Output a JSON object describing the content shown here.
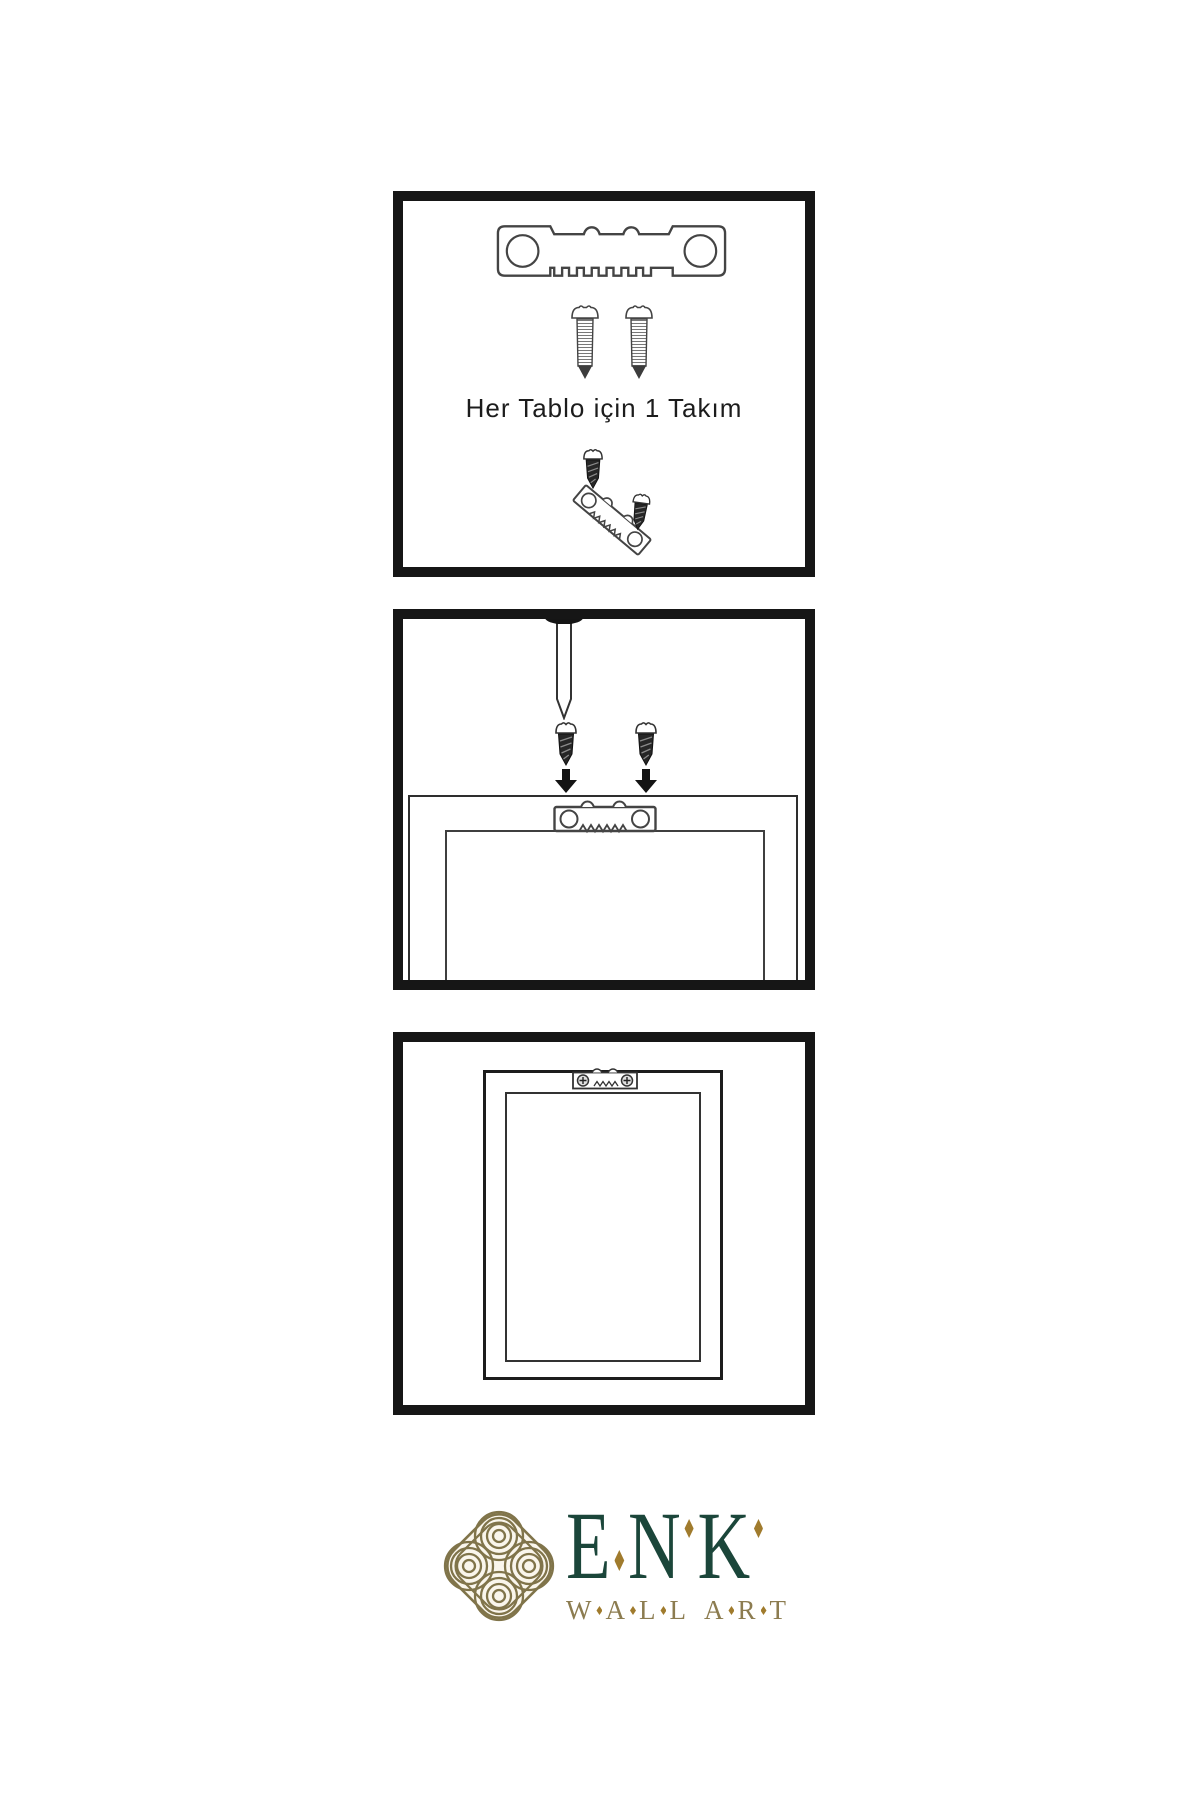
{
  "colors": {
    "ink": "#161616",
    "line": "#3a3a3a",
    "brand_green": "#1b463a",
    "brand_gold": "#8c7c50",
    "diamond_gold": "#a07b2d",
    "emblem_gold": "#80744a"
  },
  "panel1": {
    "caption": "Her Tablo için 1 Takım",
    "icons": [
      "sawtooth-hanger-icon",
      "screw-icon",
      "screw-icon",
      "screw-into-hanger-diagram"
    ]
  },
  "panel2": {
    "icons": [
      "wall-nail-icon",
      "screw-icon",
      "down-arrow-icon",
      "screw-icon",
      "down-arrow-icon",
      "frame-back-with-sawtooth-hanger"
    ]
  },
  "panel3": {
    "icons": [
      "framed-print-with-mounted-hanger"
    ]
  },
  "logo": {
    "brand_letters": [
      "E",
      "N",
      "K"
    ],
    "subtitle_words": [
      "WALL",
      "ART"
    ]
  }
}
